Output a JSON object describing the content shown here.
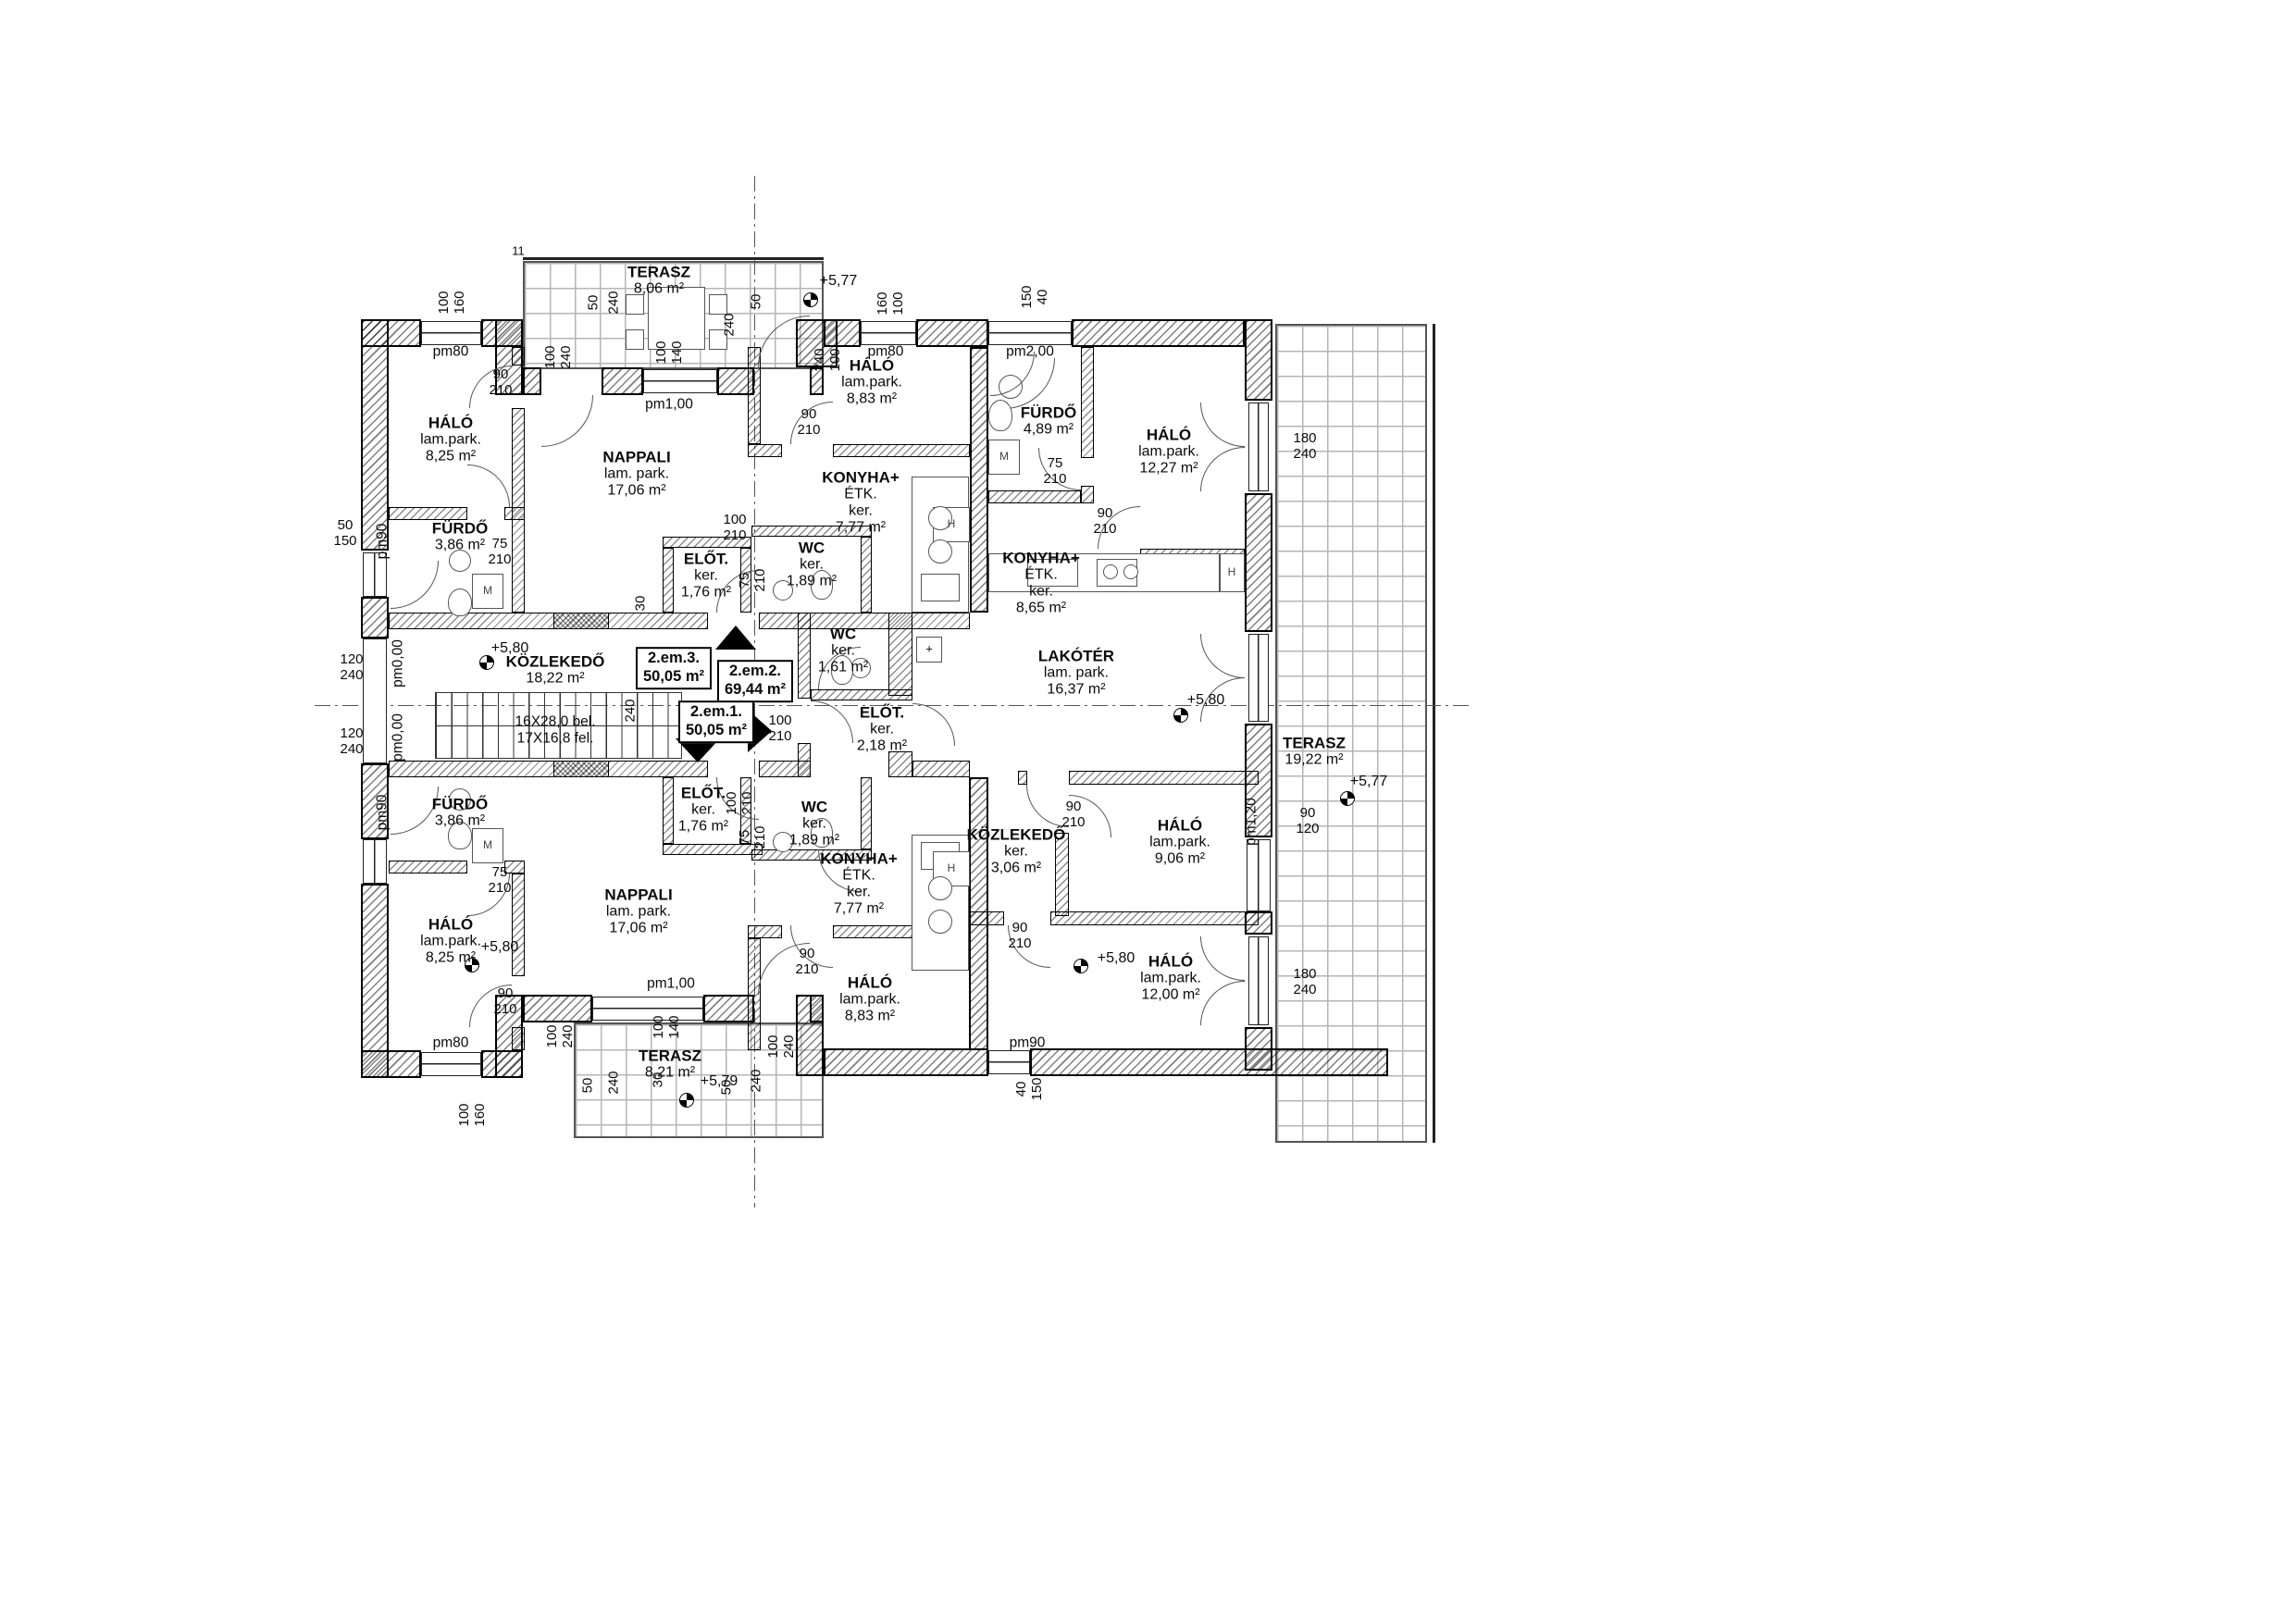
{
  "drawing": {
    "type": "floor-plan",
    "level_note": "2.em (second floor) apartment plan",
    "line_color": "#111111",
    "background": "#ffffff"
  },
  "apartments": {
    "apt-box-1": "2.em.1.\n50,05 m²",
    "apt-box-2": "2.em.2.\n69,44 m²",
    "apt-box-3": "2.em.3.\n50,05 m²"
  },
  "stair": {
    "stair-text": "16X28,0 bel.\n17X16,8 fel."
  },
  "labels": {
    "room-halo-tl": "HÁLÓ\nlam.park.\n8,25 m²",
    "room-furdo-t": "FÜRDŐ\n3,86 m²",
    "room-nappali-t": "NAPPALI\nlam. park.\n17,06 m²",
    "room-terasz-t": "TERASZ\n8,06 m²",
    "room-halo-tm": "HÁLÓ\nlam.park.\n8,83 m²",
    "room-konyha-t": "KONYHA+\nÉTK.\nker.\n7,77 m²",
    "room-elot-t": "ELŐT.\nker.\n1,76 m²",
    "room-wc-t": "WC\nker.\n1,89 m²",
    "room-furdo-r": "FÜRDŐ\n4,89 m²",
    "room-halo-r1": "HÁLÓ\nlam.park.\n12,27 m²",
    "room-konyha-r": "KONYHA+\nÉTK.\nker.\n8,65 m²",
    "room-lakoter": "LAKÓTÉR\nlam. park.\n16,37 m²",
    "room-wc-r": "WC\nker.\n1,61 m²",
    "room-elot-r": "ELŐT.\nker.\n2,18 m²",
    "room-kozlekedo-c": "KÖZLEKEDŐ\n18,22 m²",
    "room-kozlekedo-r": "KÖZLEKEDŐ\nker.\n3,06 m²",
    "room-halo-r2": "HÁLÓ\nlam.park.\n9,06 m²",
    "room-halo-r3": "HÁLÓ\nlam.park.\n12,00 m²",
    "room-terasz-r": "TERASZ\n19,22 m²",
    "room-furdo-b": "FÜRDŐ\n3,86 m²",
    "room-halo-bl": "HÁLÓ\nlam.park.\n8,25 m²",
    "room-nappali-b": "NAPPALI\nlam. park.\n17,06 m²",
    "room-elot-b": "ELŐT.\nker.\n1,76 m²",
    "room-wc-b": "WC\nker.\n1,89 m²",
    "room-konyha-b": "KONYHA+\nÉTK.\nker.\n7,77 m²",
    "room-halo-bm": "HÁLÓ\nlam.park.\n8,83 m²",
    "room-terasz-b": "TERASZ\n8,21 m²",
    "apt-box-3": "2.em.3.\n50,05 m²",
    "apt-box-2": "2.em.2.\n69,44 m²",
    "apt-box-1": "2.em.1.\n50,05 m²",
    "stair-text": "16X28,0 bel.\n17X16,8 fel.",
    "level-terasz-t": "+5,77",
    "level-kozlekedo": "+5,80",
    "level-lakoter": "+5,80",
    "level-terasz-r": "+5,77",
    "level-halo-r3": "+5,80",
    "level-halo-bl": "+5,80",
    "level-terasz-b": "+5,79",
    "sill-pm80-tl": "pm80",
    "sill-pm80-tm": "pm80",
    "sill-pm2-tr": "pm2,00",
    "sill-pm1-t": "pm1,00",
    "sill-pm90-lt": "pm90",
    "sill-pm0-1": "pm0,00",
    "sill-pm0-2": "pm0,00",
    "sill-pm90-lb": "pm90",
    "sill-pm120-r": "pm1,20",
    "sill-pm80-bl": "pm80",
    "sill-pm1-b": "pm1,00",
    "sill-pm90-br": "pm90",
    "dim-100-160-tl": "100\n160",
    "dim-90-210-d1": "90\n210",
    "dim-100-240-t": "100\n240",
    "dim-50-t1": "50",
    "dim-240-t1": "240",
    "dim-100-140-t": "100\n140",
    "dim-240-t2": "240",
    "dim-50-t2": "50",
    "dim-240-100-t": "240\n100",
    "dim-160-100-tm": "160\n100",
    "dim-90-210-d3": "90\n210",
    "dim-150-40-tr": "150\n40",
    "dim-75-210-ft": "75\n210",
    "dim-50-150-l": "50\n150",
    "dim-120-240-l1": "120\n240",
    "dim-120-240-l2": "120\n240",
    "dim-30-t": "30",
    "dim-100-210-et": "100\n210",
    "dim-75-210-wt": "75\n210",
    "dim-240-stair": "240",
    "dim-100-210-sr": "100\n210",
    "dim-75-210-fr": "75\n210",
    "dim-90-210-r1": "90\n210",
    "dim-180-240-r1": "180\n240",
    "dim-90-120-r": "90\n120",
    "dim-180-240-r2": "180\n240",
    "dim-90-210-kr": "90\n210",
    "dim-90-210-r3": "90\n210",
    "dim-75-210-fb": "75\n210",
    "dim-90-210-bl": "90\n210",
    "dim-75-210-wb": "75\n210",
    "dim-100-210-eb": "100\n210",
    "dim-90-210-bm": "90\n210",
    "dim-30-b": "30",
    "dim-100-240-bd": "100\n240",
    "dim-100-140-b": "100\n140",
    "dim-50-b1": "50",
    "dim-240-b1": "240",
    "dim-50-b2": "50",
    "dim-240-b2": "240",
    "dim-100-240-b2": "100\n240",
    "dim-100-160-bl": "100\n160",
    "dim-40-150-br": "40\n150",
    "mark-11": "11",
    "mark-plus": "+",
    "fx-m-t": "M",
    "fx-m-r": "M",
    "fx-m-b": "M",
    "fx-h-t": "H",
    "fx-h-r": "H",
    "fx-h-b": "H"
  }
}
